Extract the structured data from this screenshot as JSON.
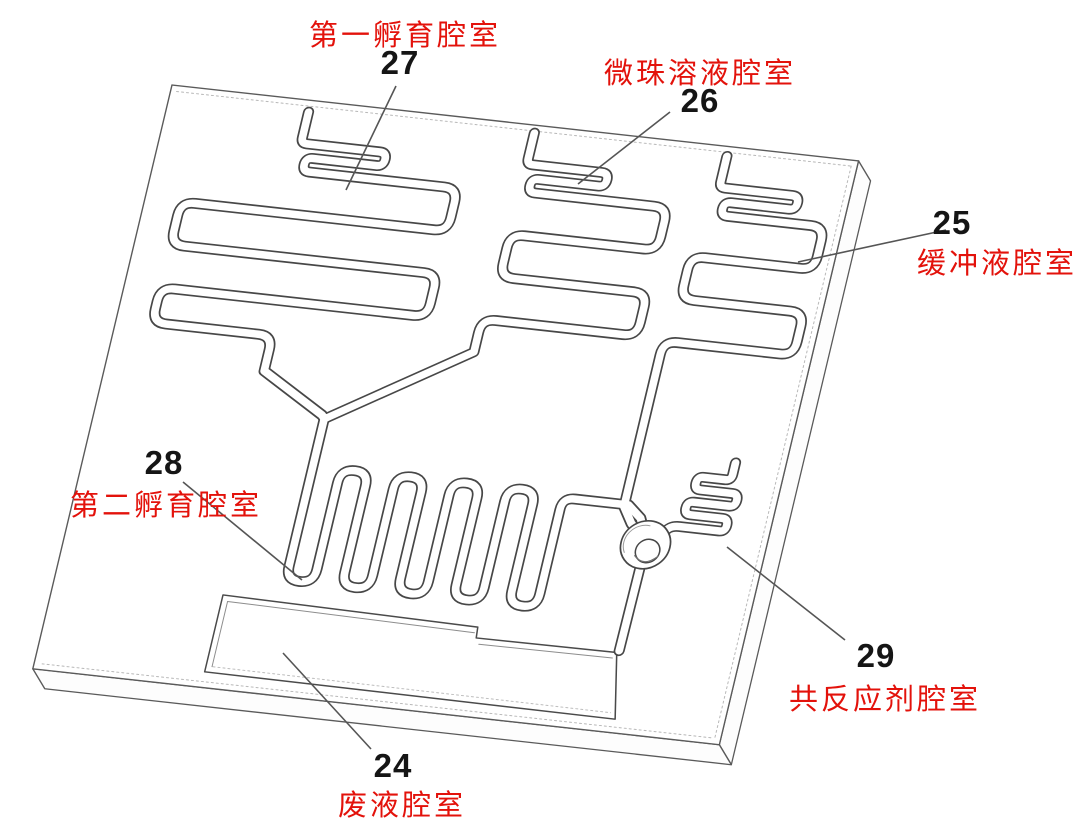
{
  "figure": {
    "kind": "microfluidic-chip-patent-diagram",
    "callouts": [
      {
        "number": "27",
        "label": "第一孵育腔室"
      },
      {
        "number": "26",
        "label": "微珠溶液腔室"
      },
      {
        "number": "25",
        "label": "缓冲液腔室"
      },
      {
        "number": "28",
        "label": "第二孵育腔室"
      },
      {
        "number": "29",
        "label": "共反应剂腔室"
      },
      {
        "number": "24",
        "label": "废液腔室"
      }
    ]
  },
  "colors": {
    "label_red": "#e3120b",
    "number_black": "#151515",
    "line_gray": "#4a4a4a",
    "background": "#ffffff"
  }
}
